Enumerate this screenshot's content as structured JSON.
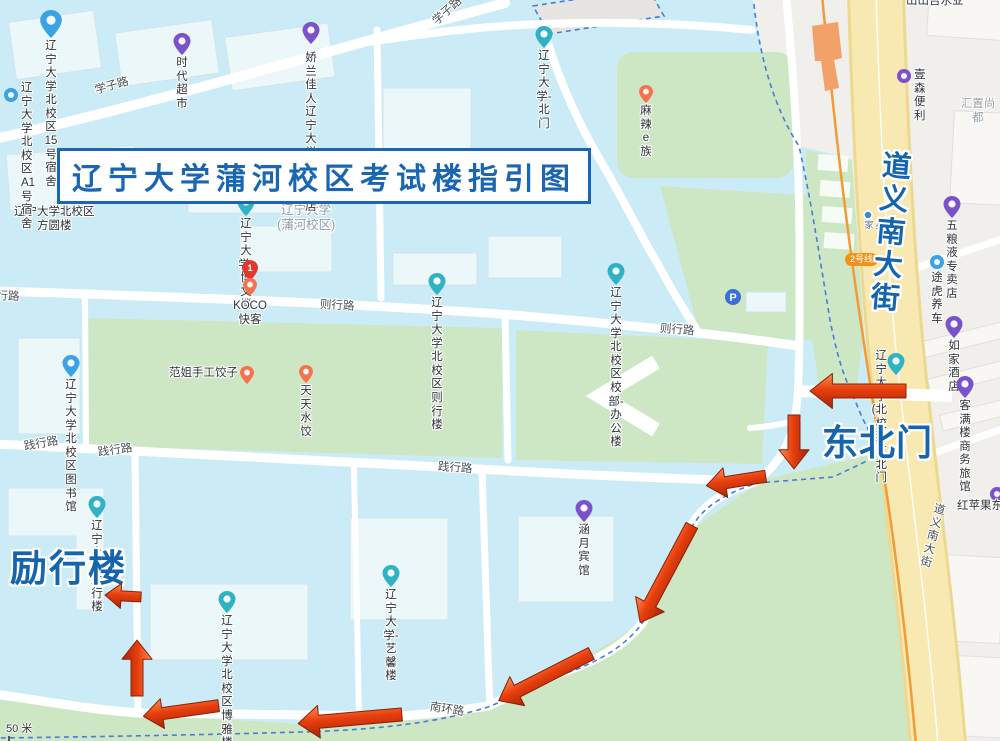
{
  "map": {
    "title": "辽宁大学蒲河校区考试楼指引图",
    "scale_label": "50 米",
    "metro_badge": {
      "text": "2号线",
      "x": 845,
      "y": 253
    },
    "colors": {
      "teal": "#2fb3c4",
      "purple": "#7a52c9",
      "blue": "#3aa3e3",
      "orange": "#f4724d",
      "red": "#e23730",
      "parking": "#3a6ed8",
      "dot": "#3a86d8",
      "arrow_main": "#e8400e",
      "accent_blue": "#1465ad",
      "metro_orange": "#f09a38",
      "boundary_blue": "#4a7bd9",
      "road_yellow": "#f8e9b2"
    },
    "big_labels": [
      {
        "id": "northeast-gate",
        "text": "东北门",
        "x": 822,
        "y": 414,
        "size": 36,
        "ls": 1
      },
      {
        "id": "lixing-building",
        "text": "励行楼",
        "x": 10,
        "y": 538,
        "size": 37,
        "ls": 2
      },
      {
        "id": "daoyi-south-street",
        "text": "道义南大街",
        "x": 867,
        "y": 150,
        "size": 29,
        "vert": true,
        "rot": 5
      }
    ],
    "road_labels": [
      {
        "text": "学子路",
        "x": 95,
        "y": 82,
        "rot": -16
      },
      {
        "text": "学子路",
        "x": 434,
        "y": 14,
        "rot": -42
      },
      {
        "text": "则行路",
        "x": -15,
        "y": 287,
        "rot": 2
      },
      {
        "text": "则行路",
        "x": 320,
        "y": 296,
        "rot": 3
      },
      {
        "text": "则行路",
        "x": 660,
        "y": 320,
        "rot": 4
      },
      {
        "text": "践行路",
        "x": 24,
        "y": 438,
        "rot": -10
      },
      {
        "text": "践行路",
        "x": 98,
        "y": 444,
        "rot": -8
      },
      {
        "text": "践行路",
        "x": 438,
        "y": 458,
        "rot": 4
      },
      {
        "text": "南环路",
        "x": 430,
        "y": 698,
        "rot": 9
      },
      {
        "text": "道义南大街",
        "x": 932,
        "y": 503,
        "rot": 14,
        "vert": true
      }
    ],
    "plain_labels": [
      {
        "id": "shanshan-text",
        "text": "山山吉水业",
        "x": 906,
        "y": -5,
        "cls": ""
      },
      {
        "id": "huizhi-text",
        "text": "汇置尚都",
        "x": 956,
        "y": 98,
        "cls": "gray"
      },
      {
        "id": "fangyuan-building-label",
        "text": "辽宁大学北校区\n方圆楼",
        "x": 14,
        "y": 206,
        "cls": ""
      },
      {
        "id": "lnu-puhe-campus-label",
        "text": "辽宁大学\n(蒲河校区)",
        "x": 277,
        "y": 203,
        "cls": "grayblue"
      }
    ],
    "pois": [
      {
        "id": "dorm-15",
        "t": "辽宁大学北校区\n15号宿舍",
        "pin": "blue",
        "px": 51,
        "py": 38,
        "lp": "below",
        "big": true
      },
      {
        "id": "times-supermarket",
        "t": "时代超市",
        "pin": "purple",
        "px": 182,
        "py": 55,
        "lp": "below"
      },
      {
        "id": "jiaolan-store",
        "t": "娇兰佳人辽宁\n大学北校区店",
        "pin": "purple",
        "px": 311,
        "py": 44,
        "lp": "below",
        "ldy": 6
      },
      {
        "id": "dorm-a1",
        "t": "辽宁大学北校区\nA1号宿舍",
        "pin": "blue-circ",
        "px": 11,
        "py": 95,
        "lp": "right",
        "ldy": -6
      },
      {
        "id": "north-gate",
        "t": "辽宁大学-北门",
        "pin": "teal",
        "px": 544,
        "py": 48,
        "lp": "below"
      },
      {
        "id": "malaezu",
        "t": "麻辣e族",
        "pin": "orange",
        "px": 646,
        "py": 103,
        "lp": "below"
      },
      {
        "id": "yisen-store",
        "t": "壹森便利",
        "pin": "purple-circ",
        "px": 904,
        "py": 76,
        "lp": "right"
      },
      {
        "id": "bowen-building",
        "t": "辽宁大学-博文楼",
        "pin": "teal",
        "px": 246,
        "py": 216,
        "lp": "below"
      },
      {
        "id": "marker-1",
        "t": "1",
        "pin": "red1",
        "px": 250,
        "py": 281,
        "lp": "none"
      },
      {
        "id": "koco-kuaike",
        "t": "KOCO快客",
        "pin": "orange",
        "px": 250,
        "py": 296,
        "lp": "below",
        "ldy": 2
      },
      {
        "id": "zexing-building",
        "t": "辽宁大学北校区\n则行楼",
        "pin": "teal",
        "px": 437,
        "py": 295,
        "lp": "below"
      },
      {
        "id": "admin-office",
        "t": "辽宁大学北校区\n校部-办公楼",
        "pin": "teal",
        "px": 616,
        "py": 285,
        "lp": "below"
      },
      {
        "id": "parking",
        "t": "P",
        "pin": "parking",
        "px": 733,
        "py": 297,
        "lp": "none"
      },
      {
        "id": "library",
        "t": "辽宁大学北校区\n图书馆",
        "pin": "blue",
        "px": 71,
        "py": 377,
        "lp": "below"
      },
      {
        "id": "fanjie-dumplings",
        "t": "范姐手工饺子",
        "pin": "orange",
        "px": 247,
        "py": 384,
        "lp": "left"
      },
      {
        "id": "tiantian-dumplings",
        "t": "天天水饺",
        "pin": "orange",
        "px": 306,
        "py": 383,
        "lp": "below"
      },
      {
        "id": "northeast-gate-pin",
        "t": "辽宁大学(北校区)\n东北门",
        "pin": "teal",
        "px": 896,
        "py": 375,
        "lp": "left",
        "two": true,
        "ldy": -8
      },
      {
        "id": "homeinn-hotel",
        "t": "如家酒店",
        "pin": "purple",
        "px": 954,
        "py": 338,
        "lp": "below"
      },
      {
        "id": "kemanlou-hotel",
        "t": "客满楼商务旅馆",
        "pin": "purple",
        "px": 965,
        "py": 398,
        "lp": "below"
      },
      {
        "id": "wuliangye-store",
        "t": "五粮液专卖店",
        "pin": "purple",
        "px": 952,
        "py": 218,
        "lp": "below"
      },
      {
        "id": "tuhu-carcare",
        "t": "途虎养车",
        "pin": "blue-circ",
        "px": 937,
        "py": 262,
        "lp": "below",
        "ldy": 8
      },
      {
        "id": "redapple",
        "t": "红苹果东",
        "pin": "purple-circ",
        "px": 997,
        "py": 494,
        "lp": "belowleft"
      },
      {
        "id": "hanyue-hotel",
        "t": "涵月宾馆",
        "pin": "purple",
        "px": 584,
        "py": 522,
        "lp": "below"
      },
      {
        "id": "yixin-building",
        "t": "辽宁大学-艺馨楼",
        "pin": "teal",
        "px": 391,
        "py": 587,
        "lp": "below"
      },
      {
        "id": "lixing-pin",
        "t": "辽宁大学-励行楼",
        "pin": "teal",
        "px": 97,
        "py": 518,
        "lp": "below"
      },
      {
        "id": "boya-building",
        "t": "辽宁大学北校区\n博雅楼",
        "pin": "teal",
        "px": 227,
        "py": 613,
        "lp": "below"
      },
      {
        "id": "xingjia-stop",
        "t": "星家",
        "pin": "dot",
        "px": 868,
        "py": 215,
        "lp": "belowv"
      }
    ],
    "route_arrows": [
      {
        "x": 858,
        "y": 391,
        "a": 180,
        "l": 96,
        "w": 14
      },
      {
        "x": 794,
        "y": 442,
        "a": 90,
        "l": 54,
        "w": 12
      },
      {
        "x": 736,
        "y": 481,
        "a": 171,
        "l": 60,
        "w": 12
      },
      {
        "x": 666,
        "y": 574,
        "a": 118,
        "l": 110,
        "w": 13
      },
      {
        "x": 545,
        "y": 677,
        "a": 153,
        "l": 104,
        "w": 13
      },
      {
        "x": 350,
        "y": 719,
        "a": 175,
        "l": 104,
        "w": 13
      },
      {
        "x": 181,
        "y": 711,
        "a": 172,
        "l": 76,
        "w": 12
      },
      {
        "x": 137,
        "y": 668,
        "a": -90,
        "l": 56,
        "w": 12
      },
      {
        "x": 123,
        "y": 596,
        "a": 183,
        "l": 36,
        "w": 10
      }
    ]
  }
}
